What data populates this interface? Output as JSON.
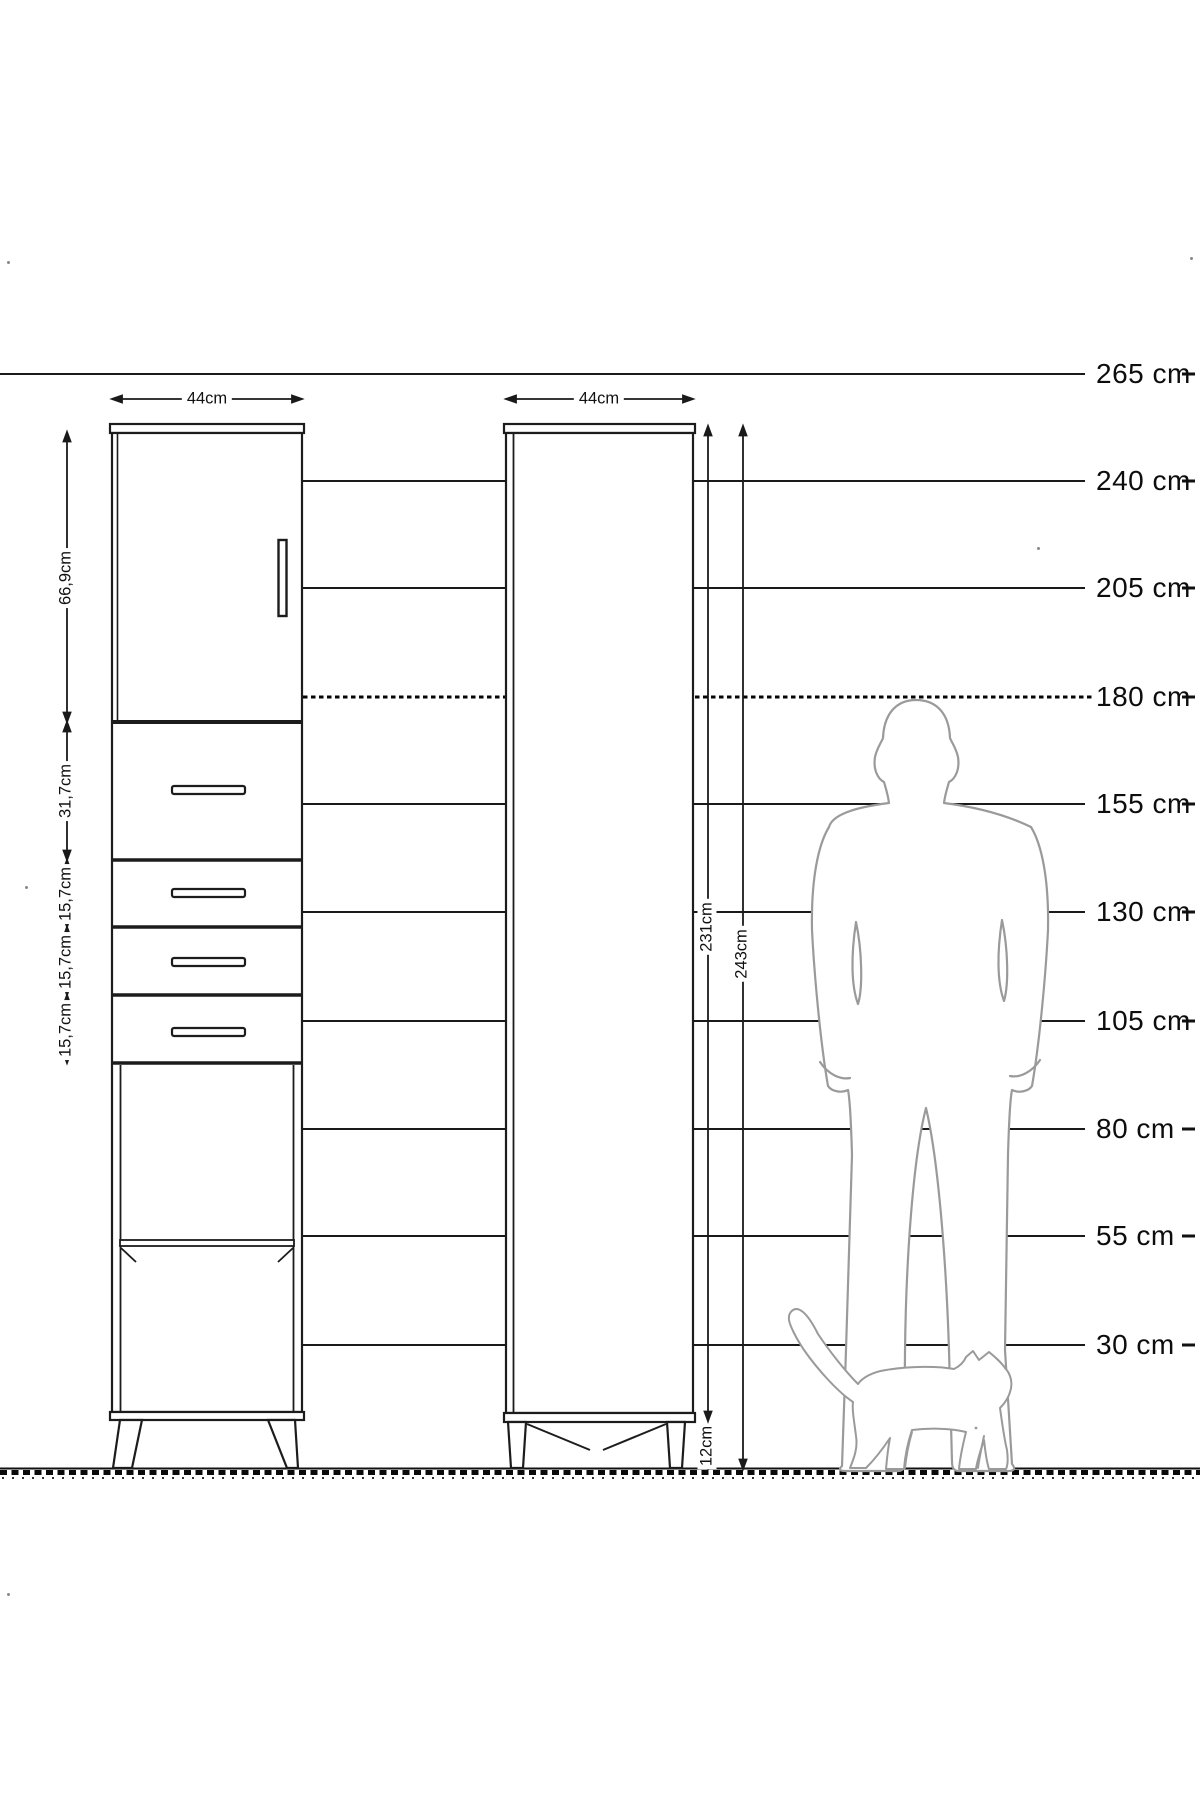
{
  "title": "cabinet-dimension-diagram",
  "colors": {
    "line": "#1a1a1a",
    "figure_outline": "#9a9a9a",
    "background": "#ffffff"
  },
  "scale": {
    "unit": "cm",
    "labels": [
      {
        "text": "265 cm",
        "cm": 265
      },
      {
        "text": "240 cm",
        "cm": 240
      },
      {
        "text": "205 cm",
        "cm": 205
      },
      {
        "text": "180 cm",
        "cm": 180
      },
      {
        "text": "155 cm",
        "cm": 155
      },
      {
        "text": "130 cm",
        "cm": 130
      },
      {
        "text": "105 cm",
        "cm": 105
      },
      {
        "text": "80 cm",
        "cm": 80
      },
      {
        "text": "55 cm",
        "cm": 55
      },
      {
        "text": "30 cm",
        "cm": 30
      }
    ],
    "dashed_line_cm": 180
  },
  "left_cabinet": {
    "width_label": "44cm",
    "sections": [
      {
        "label": "66,9cm",
        "part": "door"
      },
      {
        "label": "31,7cm",
        "part": "drawer"
      },
      {
        "label": "15,7cm",
        "part": "drawer"
      },
      {
        "label": "15,7cm",
        "part": "drawer"
      },
      {
        "label": "15,7cm",
        "part": "drawer"
      }
    ]
  },
  "right_cabinet": {
    "width_label": "44cm",
    "body_height_label": "231cm",
    "total_height_label": "243cm",
    "leg_height_label": "12cm"
  }
}
